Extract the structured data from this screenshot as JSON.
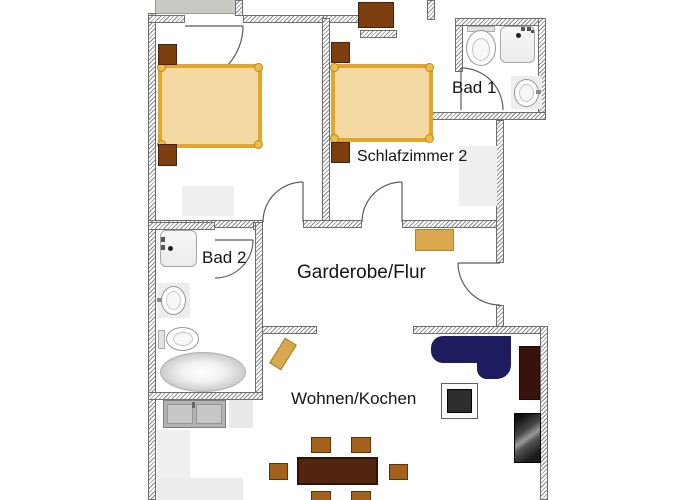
{
  "rooms": [
    {
      "id": "bad-1",
      "label": "Bad 1"
    },
    {
      "id": "schlafzimmer-2",
      "label": "Schlafzimmer 2"
    },
    {
      "id": "bad-2",
      "label": "Bad 2"
    },
    {
      "id": "garderobe-flur",
      "label": "Garderobe/Flur"
    },
    {
      "id": "wohnen-kochen",
      "label": "Wohnen/Kochen"
    }
  ],
  "colors": {
    "wall_hatch": "#8a8a8a",
    "balcony_gray": "#c9c9c3",
    "bed_fill": "#f5d9a2",
    "bed_frame": "#e2a62c",
    "wood_dark": "#7c3d0f",
    "chair_brown": "#a4611c",
    "table_dark": "#52260e",
    "cabinet_gold": "#d9a84e",
    "sofa_navy": "#1c1c5e",
    "tv_board_maroon": "#38120b",
    "armchair_dark": "#1a1a1a",
    "kitchen_gray": "#b3b3b3"
  },
  "furniture": [
    "balcony-slab",
    "bed",
    "nightstand",
    "dresser",
    "rug",
    "toilet",
    "shower",
    "washbasin",
    "bathtub",
    "wardrobe-cabinet",
    "entry-door",
    "kitchen-sink",
    "counter",
    "bench",
    "corner-sofa",
    "coffee-table",
    "tv-board",
    "armchair",
    "dining-table",
    "dining-chair"
  ]
}
